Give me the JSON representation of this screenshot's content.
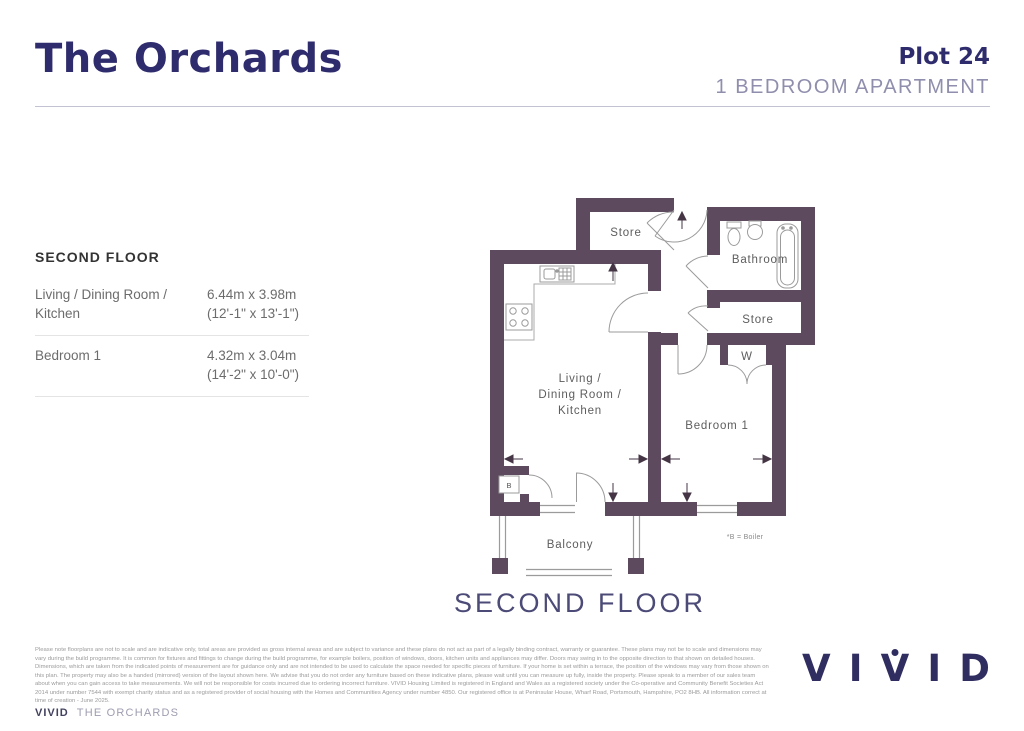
{
  "header": {
    "title": "The Orchards",
    "plot_label": "Plot 24",
    "type_label": "1 BEDROOM APARTMENT"
  },
  "dimensions_panel": {
    "heading": "SECOND FLOOR",
    "rows": [
      {
        "room": "Living / Dining Room / Kitchen",
        "metric": "6.44m x 3.98m",
        "imperial": "(12'-1\" x 13'-1\")"
      },
      {
        "room": "Bedroom 1",
        "metric": "4.32m x 3.04m",
        "imperial": "(14'-2\" x 10'-0\")"
      }
    ]
  },
  "floorplan": {
    "caption": "SECOND FLOOR",
    "labels": {
      "store_top": "Store",
      "bathroom": "Bathroom",
      "store_mid": "Store",
      "wardrobe": "W",
      "living_lines": [
        "Living /",
        "Dining Room /",
        "Kitchen"
      ],
      "bedroom": "Bedroom 1",
      "balcony": "Balcony",
      "boiler": "B",
      "boiler_note": "*B = Boiler"
    }
  },
  "footer": {
    "disclaimer": "Please note floorplans are not to scale and are indicative only, total areas are provided as gross internal areas and are subject to variance and these plans do not act as part of a legally binding contract, warranty or guarantee. These plans may not be to scale and dimensions may vary during the build programme. It is common for fixtures and fittings to change during the build programme, for example boilers, position of windows, doors, kitchen units and appliances may differ. Doors may swing in to the opposite direction to that shown on detailed houses. Dimensions, which are taken from the indicated points of measurement are for guidance only and are not intended to be used to calculate the space needed for specific pieces of furniture. If your home is set within a terrace, the position of the windows may vary from those shown on this plan. The property may also be a handed (mirrored) version of the layout shown here. We advise that you do not order any furniture based on these indicative plans, please wait until you can measure up fully, inside the property. Please speak to a member of our sales team about when you can gain access to take measurements. We will not be responsible for costs incurred due to ordering incorrect furniture. VIVID Housing Limited is registered in England and Wales as a registered society under the Co-operative and Community Benefit Societies Act 2014 under number 7544 with exempt charity status and as a registered provider of social housing with the Homes and Communities Agency under number 4850. Our registered office is at Peninsular House, Wharf Road, Portsmouth, Hampshire, PO2 8HB. All information correct at time of creation - June 2025.",
    "brand_bold": "VIVID",
    "brand_name": "THE ORCHARDS",
    "logo_letters": [
      "V",
      "I",
      "V",
      "I",
      "D"
    ]
  },
  "colors": {
    "wall": "#5e4a5e",
    "brand_navy": "#2f2c6d",
    "caption_blue": "#4c4b77",
    "subtitle_gray": "#8f8ead"
  }
}
